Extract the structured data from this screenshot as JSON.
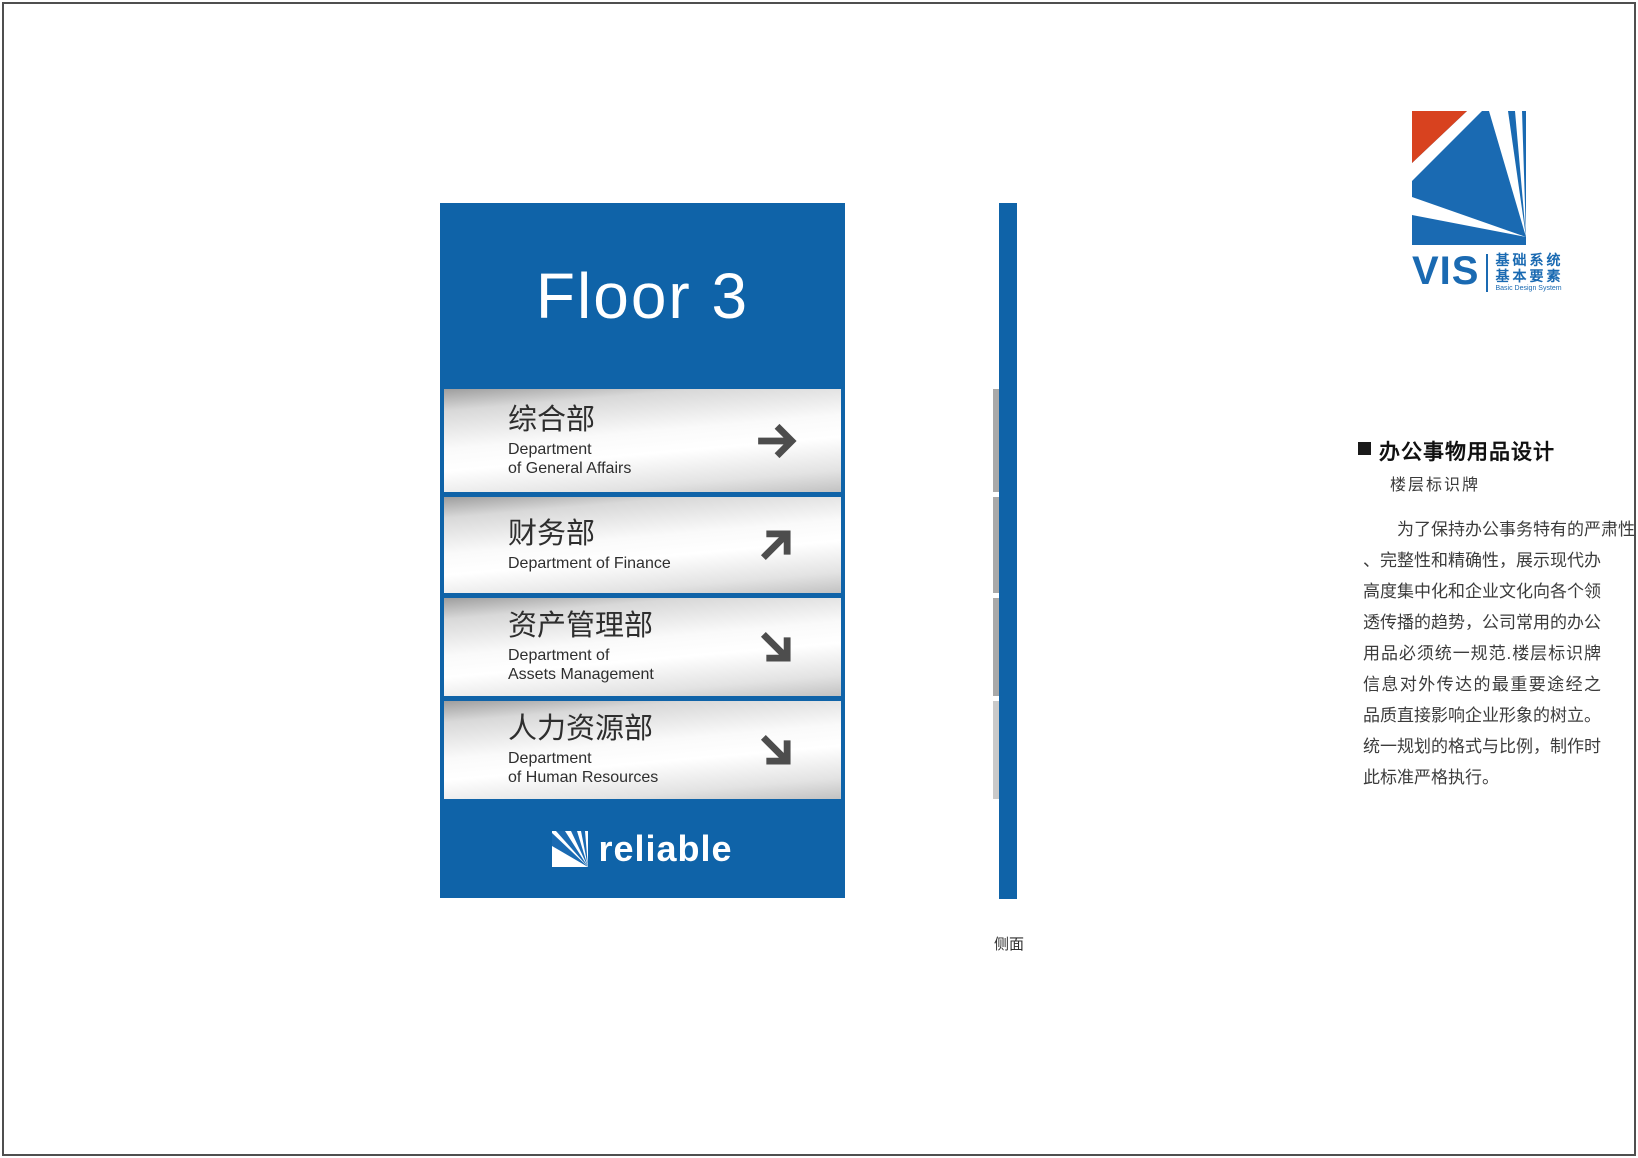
{
  "sign": {
    "floor_label": "Floor 3",
    "panel_color": "#0f63a8",
    "silver_row_color": "#e6e6e6",
    "arrow_color": "#4d4d4d",
    "rows": [
      {
        "name_zh": "综合部",
        "name_en_line1": "Department",
        "name_en_line2": "of General Affairs",
        "arrow": "right"
      },
      {
        "name_zh": "财务部",
        "name_en_line1": "Department of Finance",
        "name_en_line2": "",
        "arrow": "up-right"
      },
      {
        "name_zh": "资产管理部",
        "name_en_line1": "Department of",
        "name_en_line2": "Assets Management",
        "arrow": "down-right"
      },
      {
        "name_zh": "人力资源部",
        "name_en_line1": "Department",
        "name_en_line2": "of Human Resources",
        "arrow": "down-right"
      }
    ],
    "brand": "reliable"
  },
  "side_view": {
    "label": "侧面"
  },
  "vis_logo": {
    "wordmark": "VIS",
    "tagline_zh_line1": "基础系统",
    "tagline_zh_line2": "基本要素",
    "tagline_en": "Basic Design System",
    "red": "#d8421f",
    "blue": "#1a6ab2"
  },
  "right_panel": {
    "section_title": "办公事物用品设计",
    "section_subtitle": "楼层标识牌",
    "paragraph_lines": [
      "为了保持办公事务特有的严肃性",
      "、完整性和精确性，展示现代办公的",
      "高度集中化和企业文化向各个领域渗",
      "透传播的趋势，公司常用的办公事务",
      "用品必须统一规范.楼层标识牌是企业",
      "信息对外传达的最重要途经之一，其",
      "品质直接影响企业形象的树立。采用",
      "统一规划的格式与比例，制作时请按",
      "此标准严格执行。"
    ]
  }
}
